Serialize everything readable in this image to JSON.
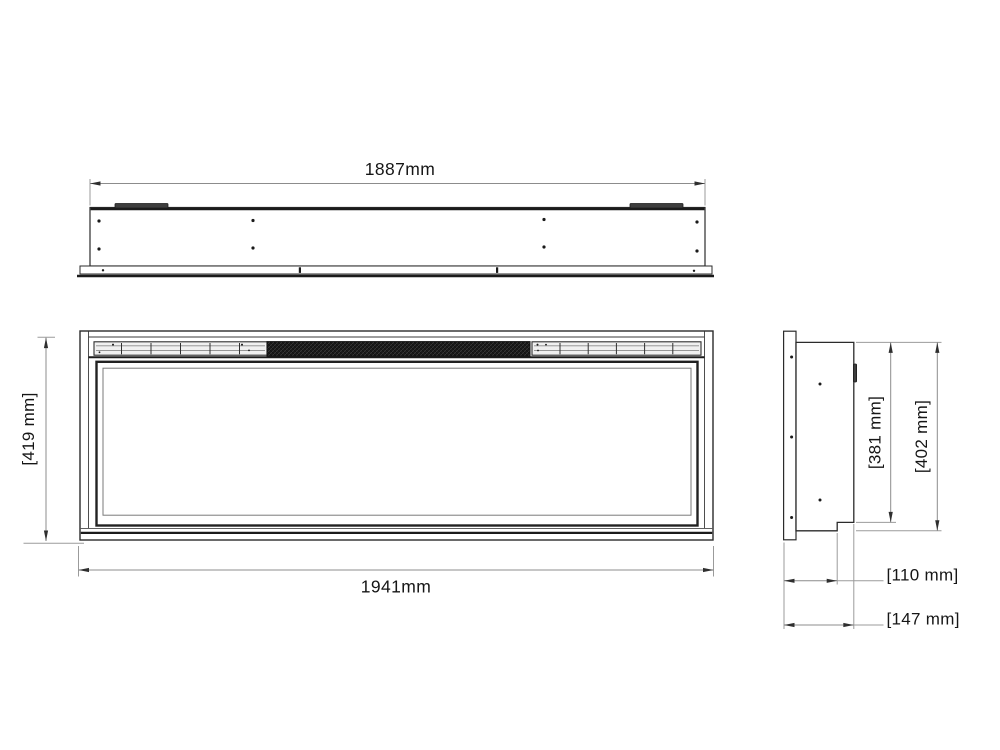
{
  "drawing": {
    "views": {
      "top_view": {
        "width_dimension": "1887mm"
      },
      "front_view": {
        "height_dimension": "[419 mm]",
        "width_dimension": "1941mm"
      },
      "side_view": {
        "inner_height_dimension": "[381 mm]",
        "overall_height_dimension": "[402 mm]",
        "inner_depth_dimension": "[110 mm]",
        "overall_depth_dimension": "[147 mm]"
      }
    },
    "colors": {
      "edge": "#2b2b2b",
      "dimension_line": "#8c8c8c",
      "arrow": "#2f2f2f",
      "label": "#161616",
      "mesh": "#191919",
      "background": "#ffffff"
    }
  }
}
